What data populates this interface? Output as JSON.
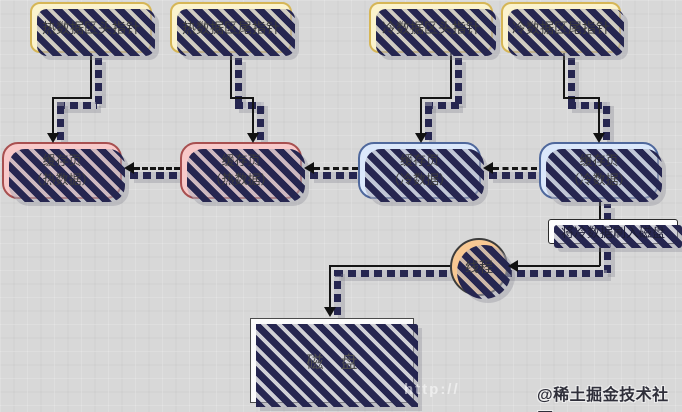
{
  "diagram": {
    "pointers": [
      {
        "label": "热数据区头指针"
      },
      {
        "label": "热数据区尾指针"
      },
      {
        "label": "冷数据区头指针"
      },
      {
        "label": "冷数据区尾指针"
      }
    ],
    "cache_pages": [
      {
        "line1": "缓存页",
        "line2": "（热数据）",
        "type": "hot"
      },
      {
        "line1": "缓存页",
        "line2": "（热数据）",
        "type": "hot"
      },
      {
        "line1": "缓存页",
        "line2": "（冷数据）",
        "type": "cold"
      },
      {
        "line1": "缓存页",
        "line2": "（冷数据）",
        "type": "cold"
      }
    ],
    "flush_label": "将冷数据刷入磁盘",
    "thread_label": "线程",
    "disk_label": "磁　盘",
    "watermark": "@稀土掘金技术社区",
    "faint_watermark": "http://",
    "colors": {
      "background": "#d8d8d8",
      "pointer_fill": "#fbf3cd",
      "pointer_stroke": "#d6b656",
      "hot_fill": "#f8c9c9",
      "hot_stroke": "#a85050",
      "cold_fill": "#dbe8fb",
      "cold_stroke": "#4f689c",
      "thread_fill": "#f8c893",
      "disk_fill": "#fbfbfb",
      "shadow": "#262650",
      "line": "#141414"
    }
  }
}
